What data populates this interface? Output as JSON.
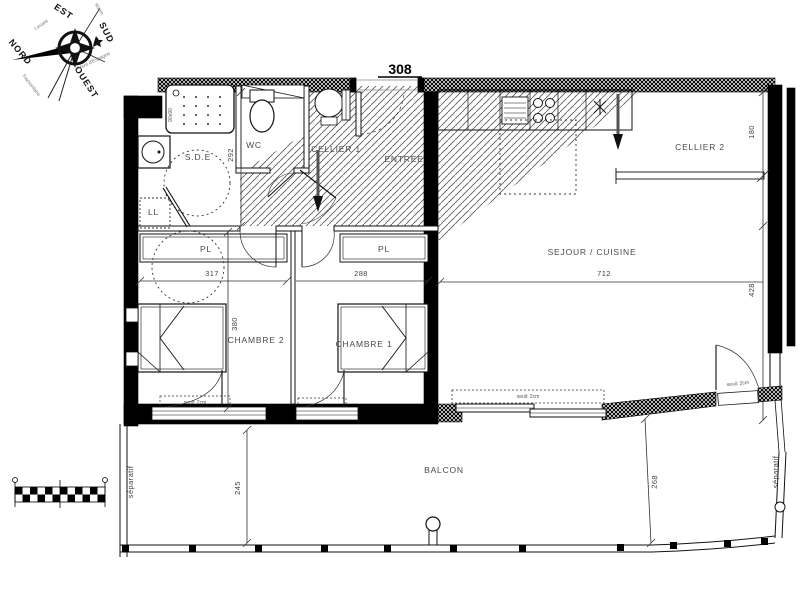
{
  "title": "308",
  "compass": {
    "cardinal": {
      "north": "NORD",
      "east": "EST",
      "south": "SUD",
      "west": "OUEST"
    },
    "winds": {
      "east": "Levant",
      "southwest": "Vent d'Espagne",
      "northwest": "Tramontane",
      "southeast": "Marin"
    }
  },
  "rooms": {
    "sde": {
      "label": "S.D.E",
      "dim_height": "292"
    },
    "wc": {
      "label": "WC"
    },
    "ll": {
      "label": "LL"
    },
    "cellier1": {
      "label": "CELLIER 1"
    },
    "entree": {
      "label": "ENTREE"
    },
    "cellier2": {
      "label": "CELLIER 2",
      "dim_height": "180"
    },
    "sejour": {
      "label": "SEJOUR / CUISINE",
      "dim_width": "712",
      "dim_height": "428"
    },
    "pl1": {
      "label": "PL",
      "dim_width": "317"
    },
    "pl2": {
      "label": "PL",
      "dim_width": "288"
    },
    "chambre2": {
      "label": "CHAMBRE 2",
      "dim_height": "380"
    },
    "chambre1": {
      "label": "CHAMBRE 1"
    },
    "balcon": {
      "label": "BALCON",
      "dim_left": "245",
      "dim_right": "268"
    }
  },
  "annotations": {
    "seuil": "seuil: 2cm",
    "separatif": "séparatif",
    "shower_size": "90x90"
  },
  "colors": {
    "wall": "#000000",
    "line": "#1b1b1b",
    "label": "#4a4a4a"
  }
}
